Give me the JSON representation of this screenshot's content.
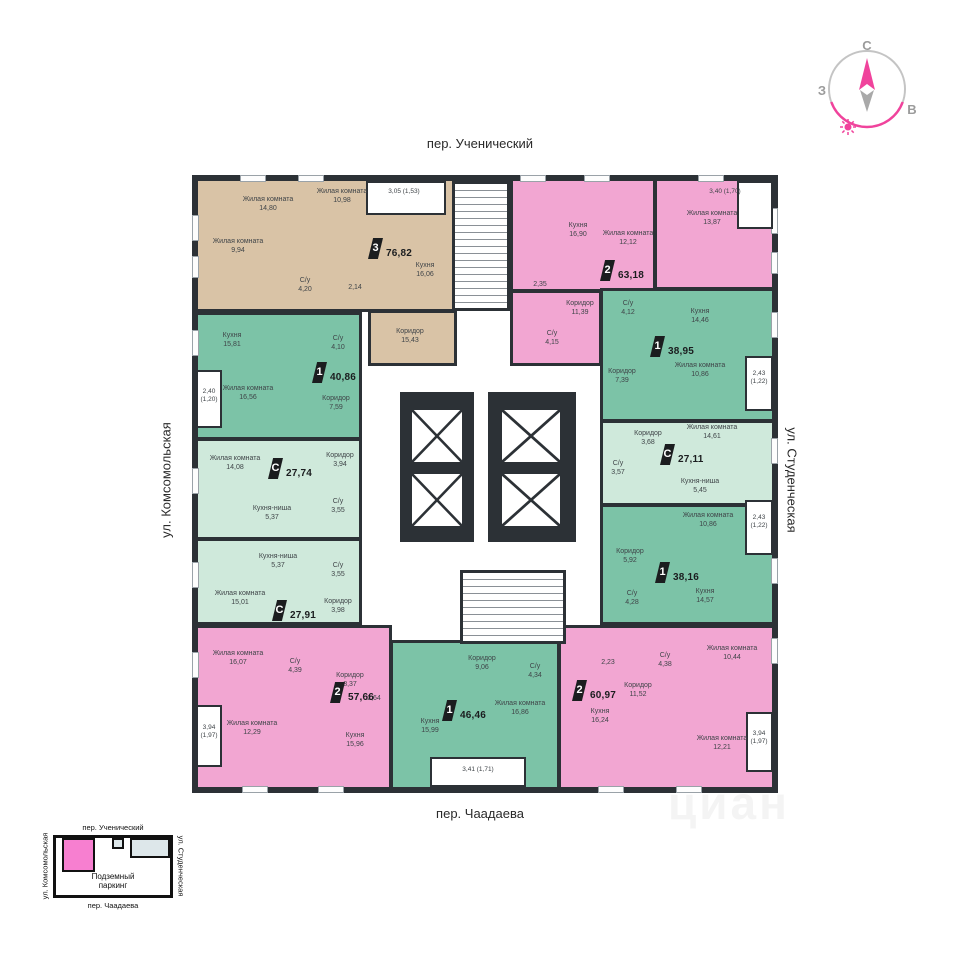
{
  "streets": {
    "top": "пер. Ученический",
    "left": "ул. Комсомольская",
    "right": "ул. Студенческая",
    "bottom": "пер. Чаадаева"
  },
  "compass": {
    "north": "С",
    "west": "З",
    "east": "В"
  },
  "colors": {
    "wall": "#2c3136",
    "pink_apartment": "#f2a6d2",
    "green_apartment": "#7cc3a7",
    "pale_green_studio": "#cfe9db",
    "beige_apartment": "#d9c3a6",
    "accent_pink": "#f0439c"
  },
  "apartments": [
    {
      "type": "3",
      "total": "76,82",
      "balcony": "3,05 (1,53)",
      "rooms": [
        {
          "name": "Жилая комната",
          "area": "14,80"
        },
        {
          "name": "Жилая комната",
          "area": "10,98"
        },
        {
          "name": "Жилая комната",
          "area": "9,94"
        },
        {
          "name": "С/у",
          "area": "4,20"
        },
        {
          "name": "",
          "area": "2,14"
        },
        {
          "name": "Кухня",
          "area": "16,06"
        },
        {
          "name": "Коридор",
          "area": "15,43"
        }
      ]
    },
    {
      "type": "2",
      "total": "63,18",
      "balcony": "3,40 (1,70)",
      "rooms": [
        {
          "name": "Кухня",
          "area": "16,90"
        },
        {
          "name": "Жилая комната",
          "area": "12,12"
        },
        {
          "name": "Жилая комната",
          "area": "13,87"
        },
        {
          "name": "",
          "area": "2,35"
        },
        {
          "name": "Коридор",
          "area": "11,39"
        },
        {
          "name": "С/у",
          "area": "4,15"
        }
      ]
    },
    {
      "type": "1",
      "total": "38,95",
      "balcony": "2,43 (1,22)",
      "rooms": [
        {
          "name": "С/у",
          "area": "4,12"
        },
        {
          "name": "Кухня",
          "area": "14,46"
        },
        {
          "name": "Коридор",
          "area": "7,39"
        },
        {
          "name": "Жилая комната",
          "area": "10,86"
        }
      ]
    },
    {
      "type": "С",
      "total": "27,11",
      "rooms": [
        {
          "name": "Коридор",
          "area": "3,68"
        },
        {
          "name": "Жилая комната",
          "area": "14,61"
        },
        {
          "name": "С/у",
          "area": "3,57"
        },
        {
          "name": "Кухня-ниша",
          "area": "5,45"
        }
      ]
    },
    {
      "type": "1",
      "total": "38,16",
      "balcony": "2,43 (1,22)",
      "rooms": [
        {
          "name": "Жилая комната",
          "area": "10,86"
        },
        {
          "name": "Коридор",
          "area": "5,92"
        },
        {
          "name": "С/у",
          "area": "4,28"
        },
        {
          "name": "Кухня",
          "area": "14,57"
        }
      ]
    },
    {
      "type": "2",
      "total": "60,97",
      "balcony": "3,94 (1,97)",
      "rooms": [
        {
          "name": "",
          "area": "2,23"
        },
        {
          "name": "С/у",
          "area": "4,38"
        },
        {
          "name": "Жилая комната",
          "area": "10,44"
        },
        {
          "name": "Коридор",
          "area": "11,52"
        },
        {
          "name": "Кухня",
          "area": "16,24"
        },
        {
          "name": "Жилая комната",
          "area": "12,21"
        }
      ]
    },
    {
      "type": "1",
      "total": "46,46",
      "balcony": "3,41 (1,71)",
      "rooms": [
        {
          "name": "Коридор",
          "area": "9,06"
        },
        {
          "name": "С/у",
          "area": "4,34"
        },
        {
          "name": "Жилая комната",
          "area": "16,86"
        },
        {
          "name": "Кухня",
          "area": "15,99"
        }
      ]
    },
    {
      "type": "2",
      "total": "57,66",
      "balcony": "3,94 (1,97)",
      "rooms": [
        {
          "name": "Жилая комната",
          "area": "16,07"
        },
        {
          "name": "С/у",
          "area": "4,39"
        },
        {
          "name": "Коридор",
          "area": "8,37"
        },
        {
          "name": "",
          "area": "2,64"
        },
        {
          "name": "Жилая комната",
          "area": "12,29"
        },
        {
          "name": "Кухня",
          "area": "15,96"
        }
      ]
    },
    {
      "type": "С",
      "total": "27,91",
      "rooms": [
        {
          "name": "Кухня-ниша",
          "area": "5,37"
        },
        {
          "name": "С/у",
          "area": "3,55"
        },
        {
          "name": "Жилая комната",
          "area": "15,01"
        },
        {
          "name": "Коридор",
          "area": "3,98"
        }
      ]
    },
    {
      "type": "С",
      "total": "27,74",
      "rooms": [
        {
          "name": "Жилая комната",
          "area": "14,08"
        },
        {
          "name": "Коридор",
          "area": "3,94"
        },
        {
          "name": "Кухня-ниша",
          "area": "5,37"
        },
        {
          "name": "С/у",
          "area": "3,55"
        }
      ]
    },
    {
      "type": "1",
      "total": "40,86",
      "balcony": "2,40 (1,20)",
      "rooms": [
        {
          "name": "Кухня",
          "area": "15,81"
        },
        {
          "name": "С/у",
          "area": "4,10"
        },
        {
          "name": "Жилая комната",
          "area": "16,56"
        },
        {
          "name": "Коридор",
          "area": "7,59"
        }
      ]
    }
  ],
  "legend": {
    "top": "пер. Ученический",
    "left": "ул. Комсомольская",
    "right": "ул. Студенческая",
    "bottom": "пер. Чаадаева",
    "parking": "Подземный паркинг"
  },
  "watermark": "циан"
}
